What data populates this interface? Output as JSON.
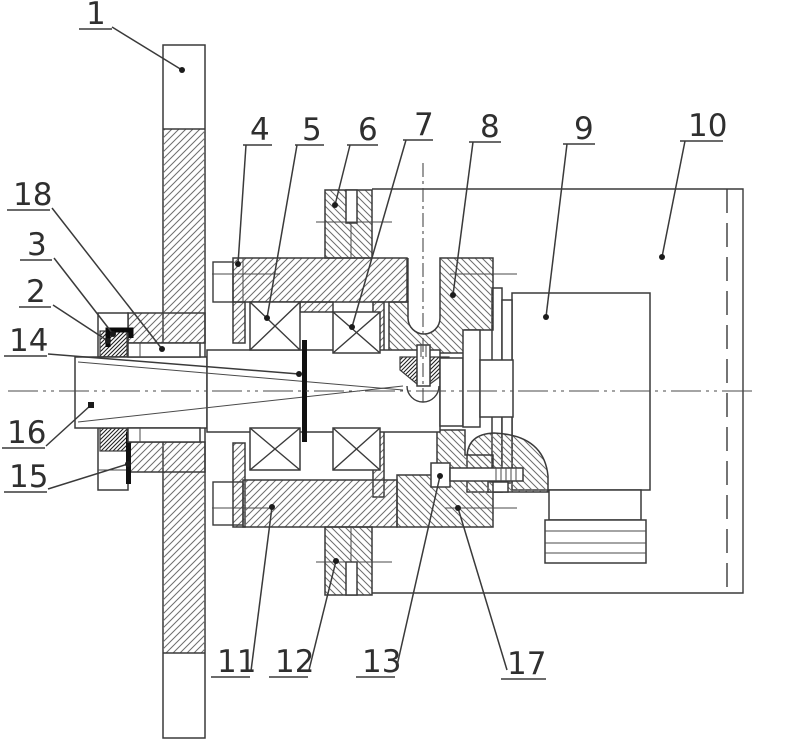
{
  "figure": {
    "kind": "patent-style mechanical cross-section drawing",
    "background_color": "#ffffff",
    "line_color": "#3a3a3a",
    "part_numbers_visible": [
      "1",
      "2",
      "3",
      "4",
      "5",
      "6",
      "7",
      "8",
      "9",
      "10",
      "11",
      "12",
      "13",
      "14",
      "15",
      "16",
      "17",
      "18"
    ]
  },
  "callouts": [
    {
      "n": "1",
      "x": 86,
      "y": 24,
      "ul": [
        79,
        112,
        29
      ],
      "leader": [
        [
          112,
          27
        ],
        [
          182,
          70
        ]
      ],
      "m": "dot"
    },
    {
      "n": "4",
      "x": 250,
      "y": 140,
      "ul": [
        243,
        272,
        145
      ],
      "leader": [
        [
          246,
          145
        ],
        [
          238,
          264
        ]
      ],
      "m": "dot"
    },
    {
      "n": "5",
      "x": 302,
      "y": 140,
      "ul": [
        295,
        324,
        145
      ],
      "leader": [
        [
          297,
          145
        ],
        [
          267,
          318
        ]
      ],
      "m": "dot"
    },
    {
      "n": "6",
      "x": 358,
      "y": 140,
      "ul": [
        347,
        378,
        145
      ],
      "leader": [
        [
          350,
          145
        ],
        [
          335,
          205
        ]
      ],
      "m": "dot"
    },
    {
      "n": "7",
      "x": 414,
      "y": 135,
      "ul": [
        403,
        433,
        140
      ],
      "leader": [
        [
          406,
          140
        ],
        [
          352,
          327
        ]
      ],
      "m": "dot"
    },
    {
      "n": "8",
      "x": 480,
      "y": 137,
      "ul": [
        469,
        501,
        142
      ],
      "leader": [
        [
          473,
          142
        ],
        [
          453,
          295
        ]
      ],
      "m": "dot"
    },
    {
      "n": "9",
      "x": 574,
      "y": 139,
      "ul": [
        563,
        595,
        144
      ],
      "leader": [
        [
          567,
          144
        ],
        [
          546,
          317
        ]
      ],
      "m": "dot"
    },
    {
      "n": "10",
      "x": 688,
      "y": 136,
      "ul": [
        680,
        723,
        141
      ],
      "leader": [
        [
          685,
          141
        ],
        [
          662,
          257
        ]
      ],
      "m": "dot"
    },
    {
      "n": "18",
      "x": 13,
      "y": 205,
      "ul": [
        7,
        50,
        210
      ],
      "leader": [
        [
          52,
          208
        ],
        [
          162,
          349
        ]
      ],
      "m": "dot"
    },
    {
      "n": "3",
      "x": 27,
      "y": 255,
      "ul": [
        20,
        52,
        260
      ],
      "leader": [
        [
          54,
          258
        ],
        [
          113,
          334
        ]
      ],
      "m": "dot"
    },
    {
      "n": "2",
      "x": 26,
      "y": 302,
      "ul": [
        19,
        51,
        307
      ],
      "leader": [
        [
          53,
          305
        ],
        [
          108,
          341
        ]
      ],
      "m": "dot"
    },
    {
      "n": "14",
      "x": 9,
      "y": 351,
      "ul": [
        4,
        47,
        356
      ],
      "leader": [
        [
          48,
          354
        ],
        [
          299,
          374
        ]
      ],
      "m": "dot"
    },
    {
      "n": "16",
      "x": 7,
      "y": 443,
      "ul": [
        2,
        45,
        448
      ],
      "leader": [
        [
          46,
          446
        ],
        [
          91,
          405
        ]
      ],
      "m": "square"
    },
    {
      "n": "15",
      "x": 9,
      "y": 487,
      "ul": [
        4,
        47,
        492
      ],
      "leader": [
        [
          48,
          489
        ],
        [
          128,
          464
        ]
      ],
      "m": "dot"
    },
    {
      "n": "11",
      "x": 217,
      "y": 672,
      "ul": [
        211,
        250,
        677
      ],
      "leader": [
        [
          251,
          671
        ],
        [
          272,
          507
        ]
      ],
      "m": "dot"
    },
    {
      "n": "12",
      "x": 275,
      "y": 672,
      "ul": [
        269,
        308,
        677
      ],
      "leader": [
        [
          309,
          670
        ],
        [
          336,
          561
        ]
      ],
      "m": "dot"
    },
    {
      "n": "13",
      "x": 362,
      "y": 672,
      "ul": [
        356,
        395,
        677
      ],
      "leader": [
        [
          396,
          670
        ],
        [
          440,
          476
        ]
      ],
      "m": "dot"
    },
    {
      "n": "17",
      "x": 507,
      "y": 674,
      "ul": [
        501,
        546,
        679
      ],
      "leader": [
        [
          507,
          670
        ],
        [
          458,
          508
        ]
      ],
      "m": "dot"
    }
  ]
}
